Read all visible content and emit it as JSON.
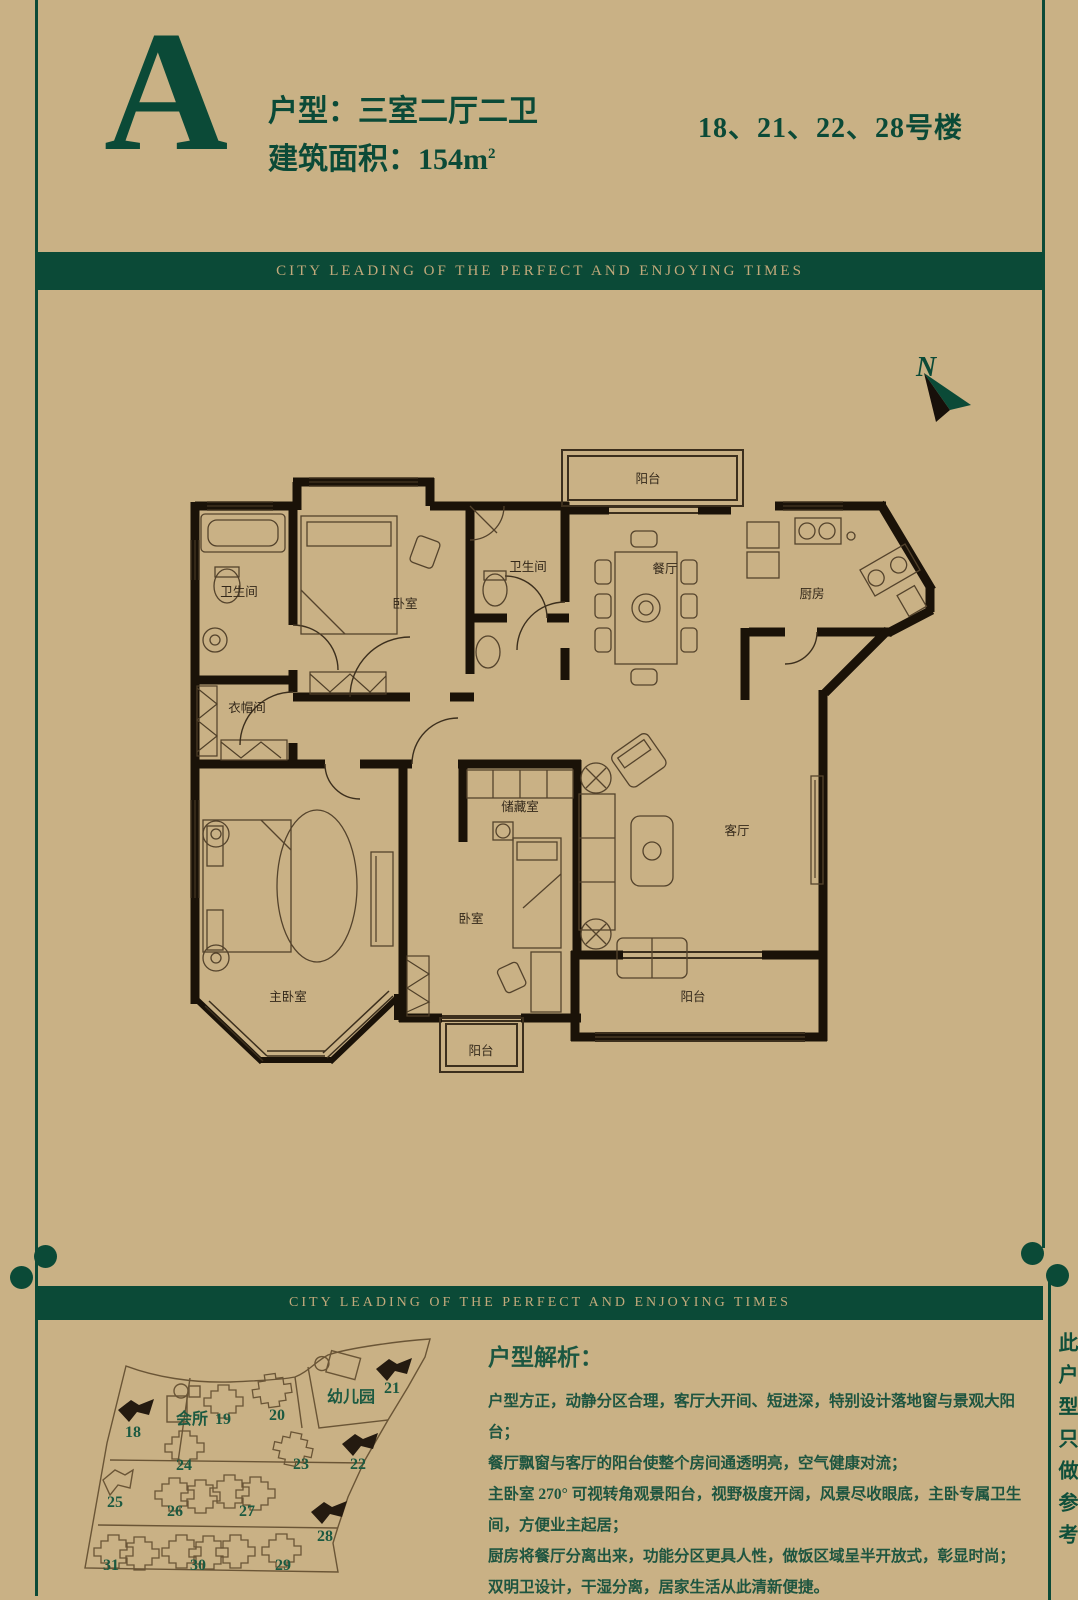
{
  "header": {
    "unit_letter": "A",
    "unit_type": "户型：三室二厅二卫",
    "area_label": "建筑面积：154m",
    "area_sup": "2",
    "buildings": "18、21、22、28号楼"
  },
  "banner": {
    "text": "CITY LEADING OF THE PERFECT AND ENJOYING TIMES"
  },
  "compass": {
    "label": "N"
  },
  "plan": {
    "rooms": {
      "balcony": "阳台",
      "dining": "餐厅",
      "kitchen": "厨房",
      "bathroom": "卫生间",
      "bedroom": "卧室",
      "cloakroom": "衣帽间",
      "master_bedroom": "主卧室",
      "storage": "储藏室",
      "living": "客厅"
    }
  },
  "sitemap": {
    "clubhouse": "会所",
    "kindergarten": "幼儿园",
    "buildings": [
      {
        "label": "18",
        "highlighted": true
      },
      {
        "label": "19",
        "highlighted": false
      },
      {
        "label": "20",
        "highlighted": false
      },
      {
        "label": "21",
        "highlighted": true
      },
      {
        "label": "22",
        "highlighted": true
      },
      {
        "label": "23",
        "highlighted": false
      },
      {
        "label": "24",
        "highlighted": false
      },
      {
        "label": "25",
        "highlighted": false
      },
      {
        "label": "26",
        "highlighted": false
      },
      {
        "label": "27",
        "highlighted": false
      },
      {
        "label": "28",
        "highlighted": true
      },
      {
        "label": "29",
        "highlighted": false
      },
      {
        "label": "30",
        "highlighted": false
      },
      {
        "label": "31",
        "highlighted": false
      }
    ]
  },
  "analysis": {
    "heading": "户型解析：",
    "lines": [
      "户型方正，动静分区合理，客厅大开间、短进深，特别设计落地窗与景观大阳台；",
      "餐厅飘窗与客厅的阳台使整个房间通透明亮，空气健康对流；",
      "主卧室 270° 可视转角观景阳台，视野极度开阔，风景尽收眼底，主卧专属卫生间，方便业主起居；",
      "厨房将餐厅分离出来，功能分区更具人性，做饭区域呈半开放式，彰显时尚；",
      "双明卫设计，干湿分离，居家生活从此清新便捷。"
    ]
  },
  "side_note": "此户型只做参考",
  "colors": {
    "background": "#c9b185",
    "dark_green": "#0b4a37",
    "banner_text": "#c2a97b",
    "wall_black": "#1a1208",
    "plan_line": "#54432c",
    "site_green": "#1c5a41"
  }
}
